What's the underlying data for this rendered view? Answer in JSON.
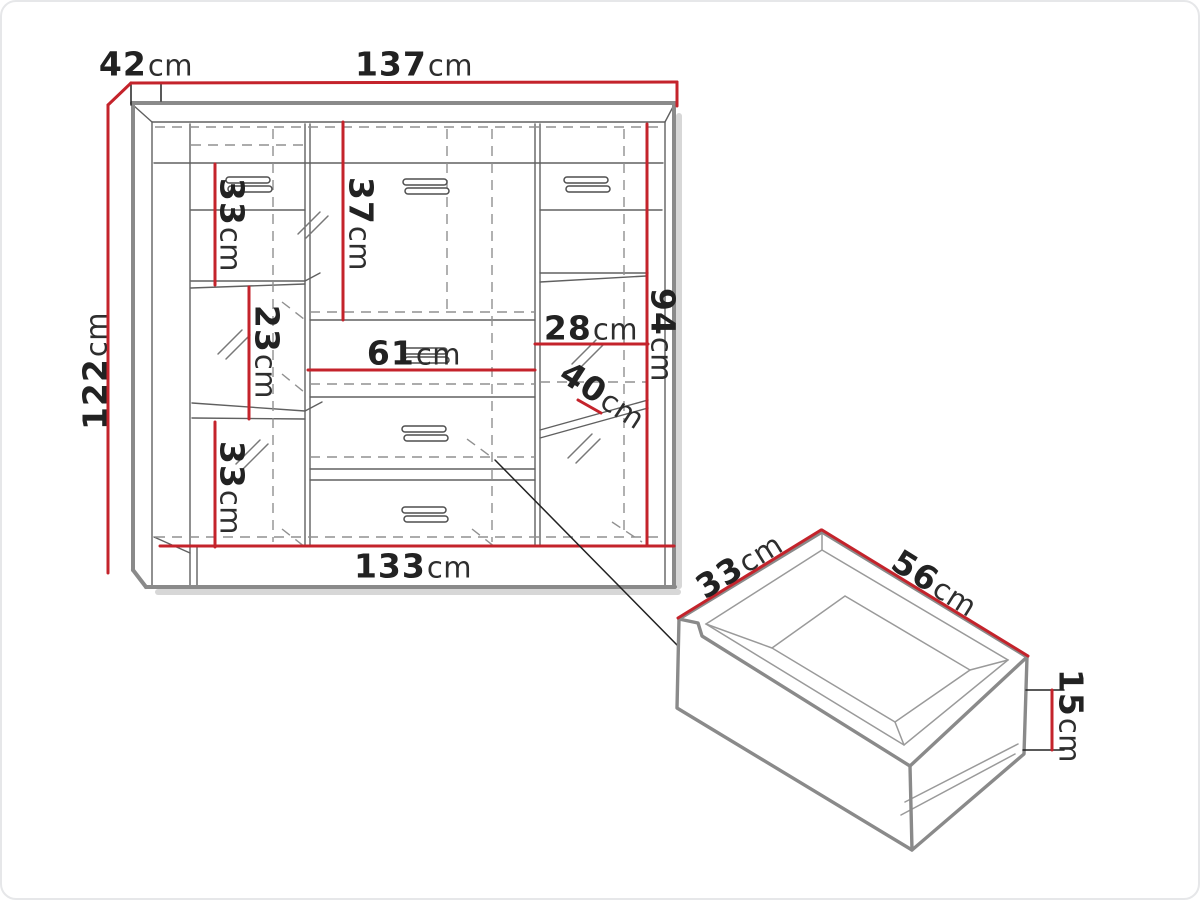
{
  "figure": {
    "type": "furniture-dimension-diagram",
    "colors": {
      "dimension_line": "#c4232b",
      "outline": "#8a8a8a",
      "inner_line": "#606060",
      "dashed_line": "#909090",
      "ink": "#222222"
    },
    "labels": {
      "cab_depth_top": {
        "num": "42",
        "unit": "cm"
      },
      "cab_width_top": {
        "num": "137",
        "unit": "cm"
      },
      "cab_height_left": {
        "num": "122",
        "unit": "cm"
      },
      "left_shelf_top": {
        "num": "33",
        "unit": "cm"
      },
      "center_door": {
        "num": "37",
        "unit": "cm"
      },
      "left_shelf_mid": {
        "num": "23",
        "unit": "cm"
      },
      "center_niche": {
        "num": "61",
        "unit": "cm"
      },
      "right_shelf": {
        "num": "28",
        "unit": "cm"
      },
      "right_inner_height": {
        "num": "94",
        "unit": "cm"
      },
      "right_depth": {
        "num": "40",
        "unit": "cm"
      },
      "left_shelf_bottom": {
        "num": "33",
        "unit": "cm"
      },
      "cab_width_bottom": {
        "num": "133",
        "unit": "cm"
      },
      "drawer_depth": {
        "num": "33",
        "unit": "cm"
      },
      "drawer_width": {
        "num": "56",
        "unit": "cm"
      },
      "drawer_height": {
        "num": "15",
        "unit": "cm"
      }
    },
    "dimensions_cm": {
      "cabinet": {
        "width": 137,
        "depth": 42,
        "height": 122,
        "width_bottom": 133,
        "interior": {
          "left_shelf_top": 33,
          "left_shelf_mid": 23,
          "left_shelf_bottom": 33,
          "center_door": 37,
          "center_niche": 61,
          "right_shelf": 28,
          "right_inner_height": 94,
          "right_depth": 40
        }
      },
      "drawer": {
        "depth": 33,
        "width": 56,
        "height": 15
      }
    }
  }
}
